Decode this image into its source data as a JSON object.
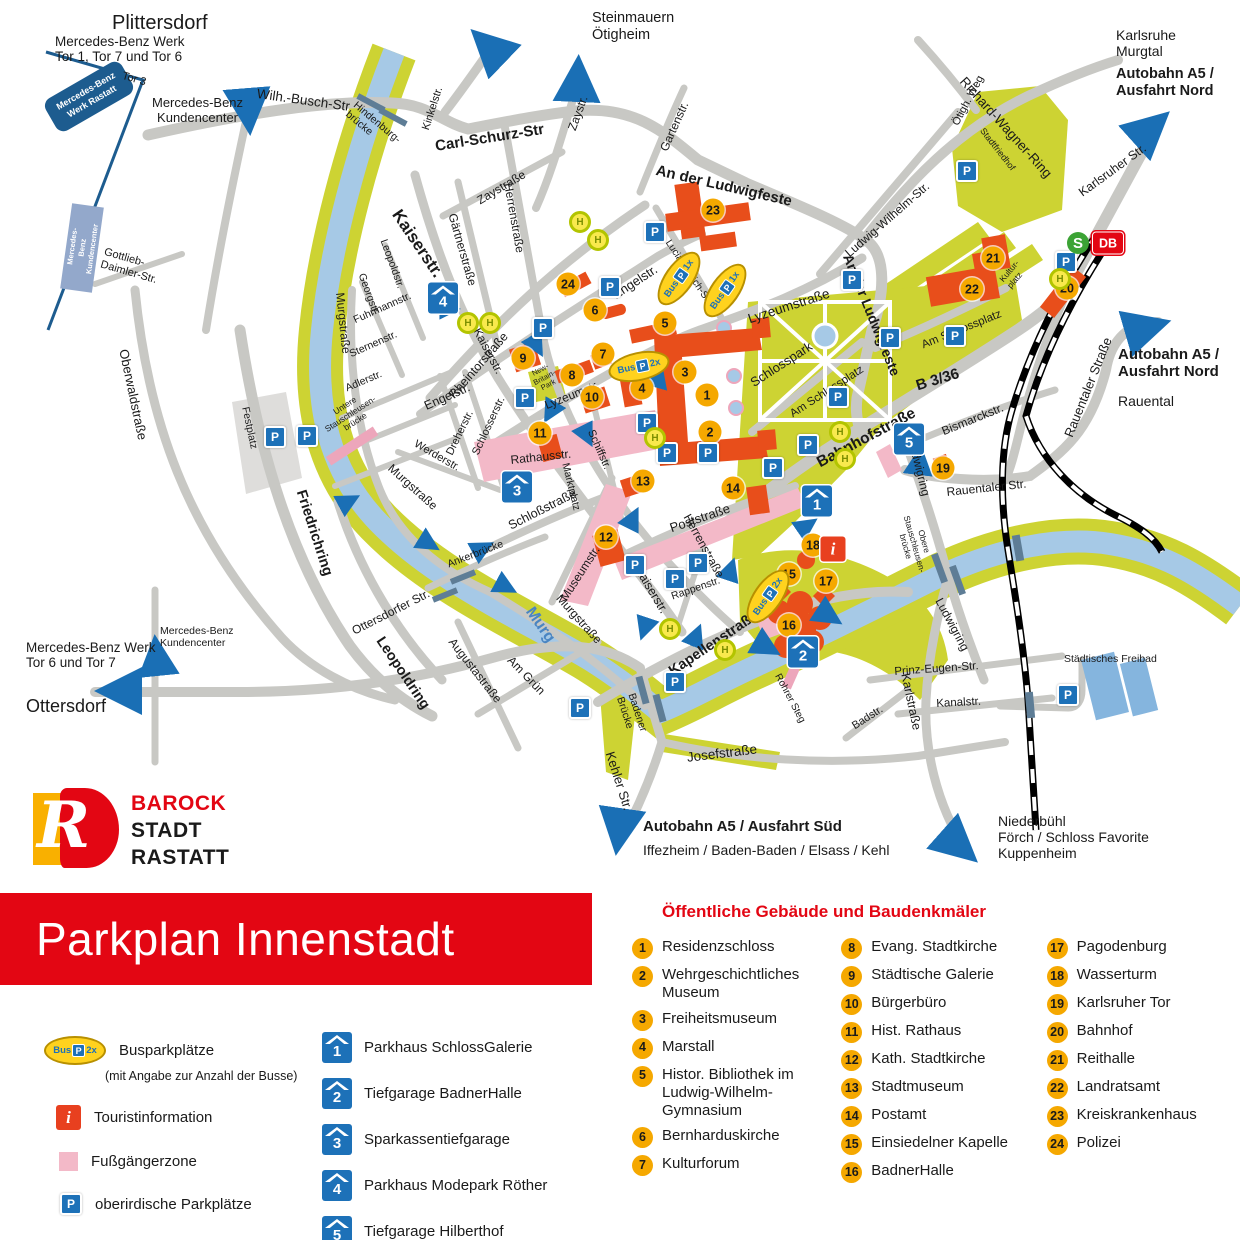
{
  "title": "Parkplan Innenstadt",
  "logo": {
    "line1": "BAROCK",
    "line2": "STADT",
    "line3": "RASTATT"
  },
  "icons": {
    "p": "P",
    "h": "H",
    "i": "i",
    "s": "S",
    "db": "DB",
    "bus": "Bus"
  },
  "legend": {
    "bus_label": "Busparkplätze",
    "bus_sub": "(mit Angabe zur Anzahl der Busse)",
    "tourist": "Touristinformation",
    "pedestrian": "Fußgängerzone",
    "surface": "oberirdische Parkplätze"
  },
  "parkhaus": {
    "items": [
      {
        "num": "1",
        "label": "Parkhaus SchlossGalerie"
      },
      {
        "num": "2",
        "label": "Tiefgarage BadnerHalle"
      },
      {
        "num": "3",
        "label": "Sparkassentiefgarage"
      },
      {
        "num": "4",
        "label": "Parkhaus Modepark Röther"
      },
      {
        "num": "5",
        "label": "Tiefgarage Hilberthof"
      }
    ]
  },
  "poi": {
    "heading": "Öffentliche Gebäude und Baudenkmäler",
    "items": [
      {
        "num": "1",
        "label": "Residenzschloss"
      },
      {
        "num": "2",
        "label": "Wehrgeschichtliches Museum"
      },
      {
        "num": "3",
        "label": "Freiheitsmuseum"
      },
      {
        "num": "4",
        "label": "Marstall"
      },
      {
        "num": "5",
        "label": "Histor. Bibliothek im Ludwig-Wilhelm-Gymnasium"
      },
      {
        "num": "6",
        "label": "Bernharduskirche"
      },
      {
        "num": "7",
        "label": "Kulturforum"
      },
      {
        "num": "8",
        "label": "Evang. Stadtkirche"
      },
      {
        "num": "9",
        "label": "Städtische Galerie"
      },
      {
        "num": "10",
        "label": "Bürgerbüro"
      },
      {
        "num": "11",
        "label": "Hist. Rathaus"
      },
      {
        "num": "12",
        "label": "Kath. Stadtkirche"
      },
      {
        "num": "13",
        "label": "Stadtmuseum"
      },
      {
        "num": "14",
        "label": "Postamt"
      },
      {
        "num": "15",
        "label": "Einsiedelner Kapelle"
      },
      {
        "num": "16",
        "label": "BadnerHalle"
      },
      {
        "num": "17",
        "label": "Pagodenburg"
      },
      {
        "num": "18",
        "label": "Wasserturm"
      },
      {
        "num": "19",
        "label": "Karlsruher Tor"
      },
      {
        "num": "20",
        "label": "Bahnhof"
      },
      {
        "num": "21",
        "label": "Reithalle"
      },
      {
        "num": "22",
        "label": "Landratsamt"
      },
      {
        "num": "23",
        "label": "Kreiskrankenhaus"
      },
      {
        "num": "24",
        "label": "Polizei"
      }
    ]
  },
  "map": {
    "bus_counts": {
      "b1": "2x",
      "b2": "1x",
      "b3": "1x",
      "b4": "2x",
      "legend": "2x"
    },
    "labels": {
      "plittersdorf": "Plittersdorf",
      "mb_nord": "Mercedes-Benz Werk\nTor 1, Tor 7 und Tor 6",
      "tor3": "Tor 3",
      "mb_box_n": "Mercedes-Benz\nWerk Rastatt",
      "mb_kunden_n": "Mercedes-Benz\nKundencenter",
      "mb_box_w": "Mercedes-Benz\nKundencenter",
      "gottlieb": "Gottlieb-\nDaimler-Str.",
      "oberwald": "Oberwaldstraße",
      "wilhbusch": "Wilh.-Busch-Str",
      "hindenburg": "Hindenburg-\nbrücke",
      "kinkel": "Kinkelstr.",
      "carlschurz": "Carl-Schurz-Str",
      "zaystr_n": "Zaystr.",
      "zaystrasse": "Zaystraße",
      "gartenstr": "Gartenstr.",
      "steinmauern": "Steinmauern\nÖtigheim",
      "herrenstr_n": "Herrenstraße",
      "gaertner": "Gärtnerstraße",
      "kaiserstr_nw": "Kaiserstr.",
      "leopoldstr": "Leopoldstr.",
      "georgstr": "Georgstr.",
      "fuhrmann": "Fuhrmannstr.",
      "sternen": "Sternenstr.",
      "adler": "Adlerstr.",
      "murgstr_n": "Murgstraße",
      "rheintor": "Rheintorstraße",
      "engelstr_w": "Engelstr.",
      "ludwigfeste_n": "An der Ludwigfeste",
      "lucian": "Lucian-Reich-Str.",
      "engelstr_e": "Engelstr.",
      "lyzeumstrasse_e": "Lyzeumstraße",
      "richardwagner": "Richard-Wagner-Ring",
      "oetigh": "Ötigh. Weg",
      "stadtfriedhof": "Stadtfriedhof",
      "ludwigwilhelm": "Ludwig-Wilhelm-Str.",
      "karlsruhe": "Karlsruhe\nMurgtal",
      "autnord_t": "Autobahn A5 /\nAusfahrt Nord",
      "karlsruherstr": "Karlsruher Str.",
      "ludwigfeste_e": "An der Ludwigfeste",
      "amschloss_ne": "Am Schlossplatz",
      "kulturplatz": "Kultur-\nplatz",
      "b336": "B 3/36",
      "schlosspark": "Schlosspark",
      "amschloss_w": "Am Schlossplatz",
      "lyzeumstr_w": "Lyzeumstr.",
      "newbritain": "New-\nBritain-\nPark",
      "rathausstr": "Rathausstr.",
      "marktplatz": "Marktplatz",
      "schlosserstr": "Schlosserstr.",
      "dreherstr": "Dreherstr.",
      "werderstr": "Werderstr.",
      "murgstr_w": "Murgstraße",
      "festplatz": "Festplatz",
      "untere": "Untere\nStauschleusen-\nbrücke",
      "friedrichring": "Friedrichring",
      "schlossstr": "Schloßstraße",
      "ankerbruecke": "Ankerbrücke",
      "museumstr": "Museumstr.",
      "schiffstr": "Schiffstr.",
      "kaiserstr_c": "Kaiserstr.",
      "poststr": "Poststraße",
      "herrenstr_s": "Herrenstraße",
      "rappenstr": "Rappenstr.",
      "kaiserstr_s": "Kaiserstr.",
      "murgstr_s": "Murgstraße",
      "murg": "Murg",
      "kapellen": "Kapellenstraße",
      "rohrersteg": "Rohrer Steg",
      "badener": "Badener\nBrücke",
      "kehler": "Kehler Str.",
      "josefstr": "Josefstraße",
      "amgruen": "Am Grün",
      "augustastr": "Augustastraße",
      "ottersdorferstr": "Ottersdorfer Str.",
      "leopoldring": "Leopoldring",
      "autsued1": "Autobahn A5 / Ausfahrt Süd",
      "autsued2": "Iffezheim / Baden-Baden / Elsass / Kehl",
      "ottersdorf": "Ottersdorf",
      "mb_sued": "Mercedes-Benz Werk\nTor 6 und Tor 7",
      "mb_kunden_s": "Mercedes-Benz\nKundencenter",
      "bahnhofstr": "Bahnhofstraße",
      "bismarck": "Bismarckstr.",
      "ludwigring_n": "Ludwigring",
      "rauentaler_s": "Rauentaler Str.",
      "rauentaler_e": "Rauentaler Straße",
      "autnord_r1": "Autobahn A5 /\nAusfahrt Nord",
      "rauental": "Rauental",
      "obere": "Obere\nStauschleusen-\nbrücke",
      "ludwigring_s": "Ludwigring",
      "prinzeugen": "Prinz-Eugen-Str.",
      "kanalstr": "Kanalstr.",
      "badstr": "Badstr.",
      "karlstrasse": "Karlstraße",
      "freibad": "Städtisches Freibad",
      "niederbuehl": "Niederbühl\nFörch / Schloss Favorite\nKuppenheim"
    }
  }
}
